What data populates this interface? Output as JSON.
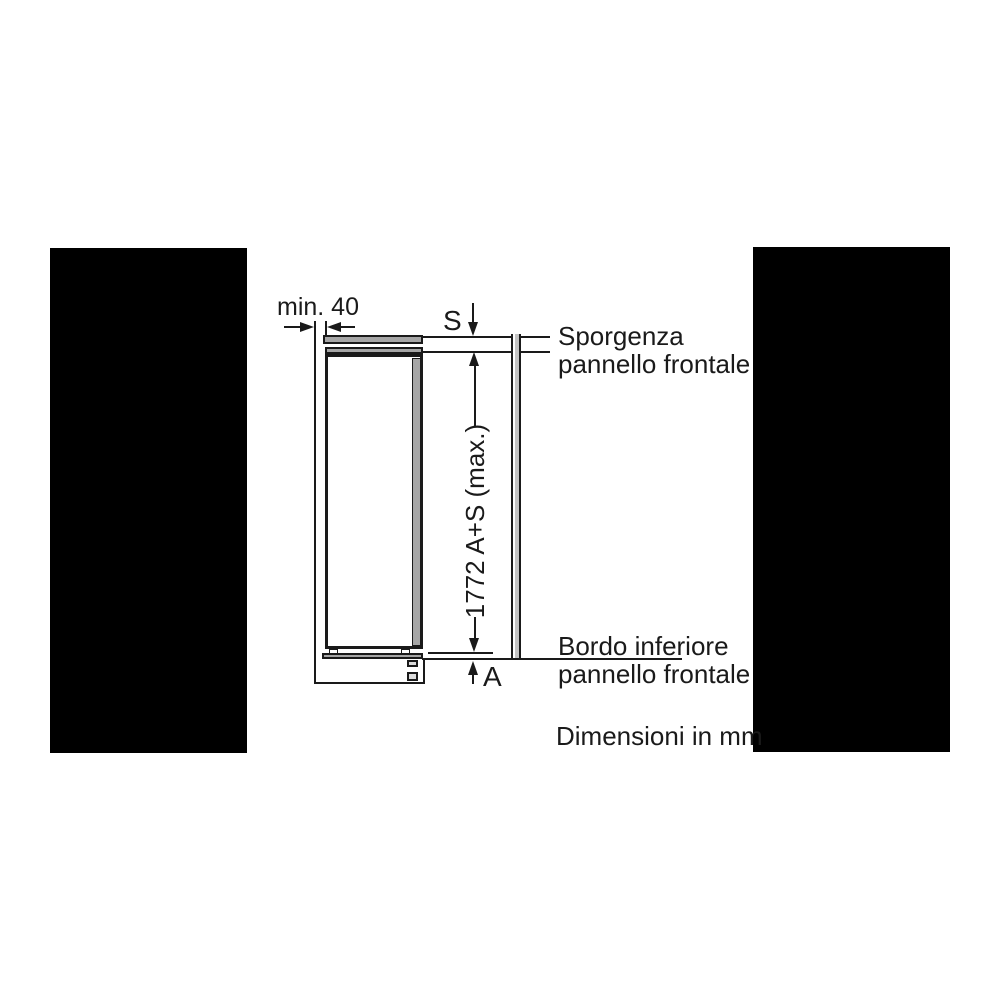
{
  "dimensions": {
    "min_gap": "min. 40",
    "overhang_s": "S",
    "gap_a": "A",
    "niche_height": "1772 A+S (max.)"
  },
  "callouts": {
    "front_panel_top": {
      "line1": "Sporgenza",
      "line2": "pannello frontale"
    },
    "front_panel_bottom": {
      "line1": "Bordo inferiore",
      "line2": "pannello frontale"
    }
  },
  "footnote": "Dimensioni in mm",
  "colors": {
    "line": "#1a1a1a",
    "appliance_fill_gray": "#a6a6a6",
    "front_panel_gray": "#c4c4c4",
    "mask_black": "#000000",
    "background": "#ffffff"
  }
}
